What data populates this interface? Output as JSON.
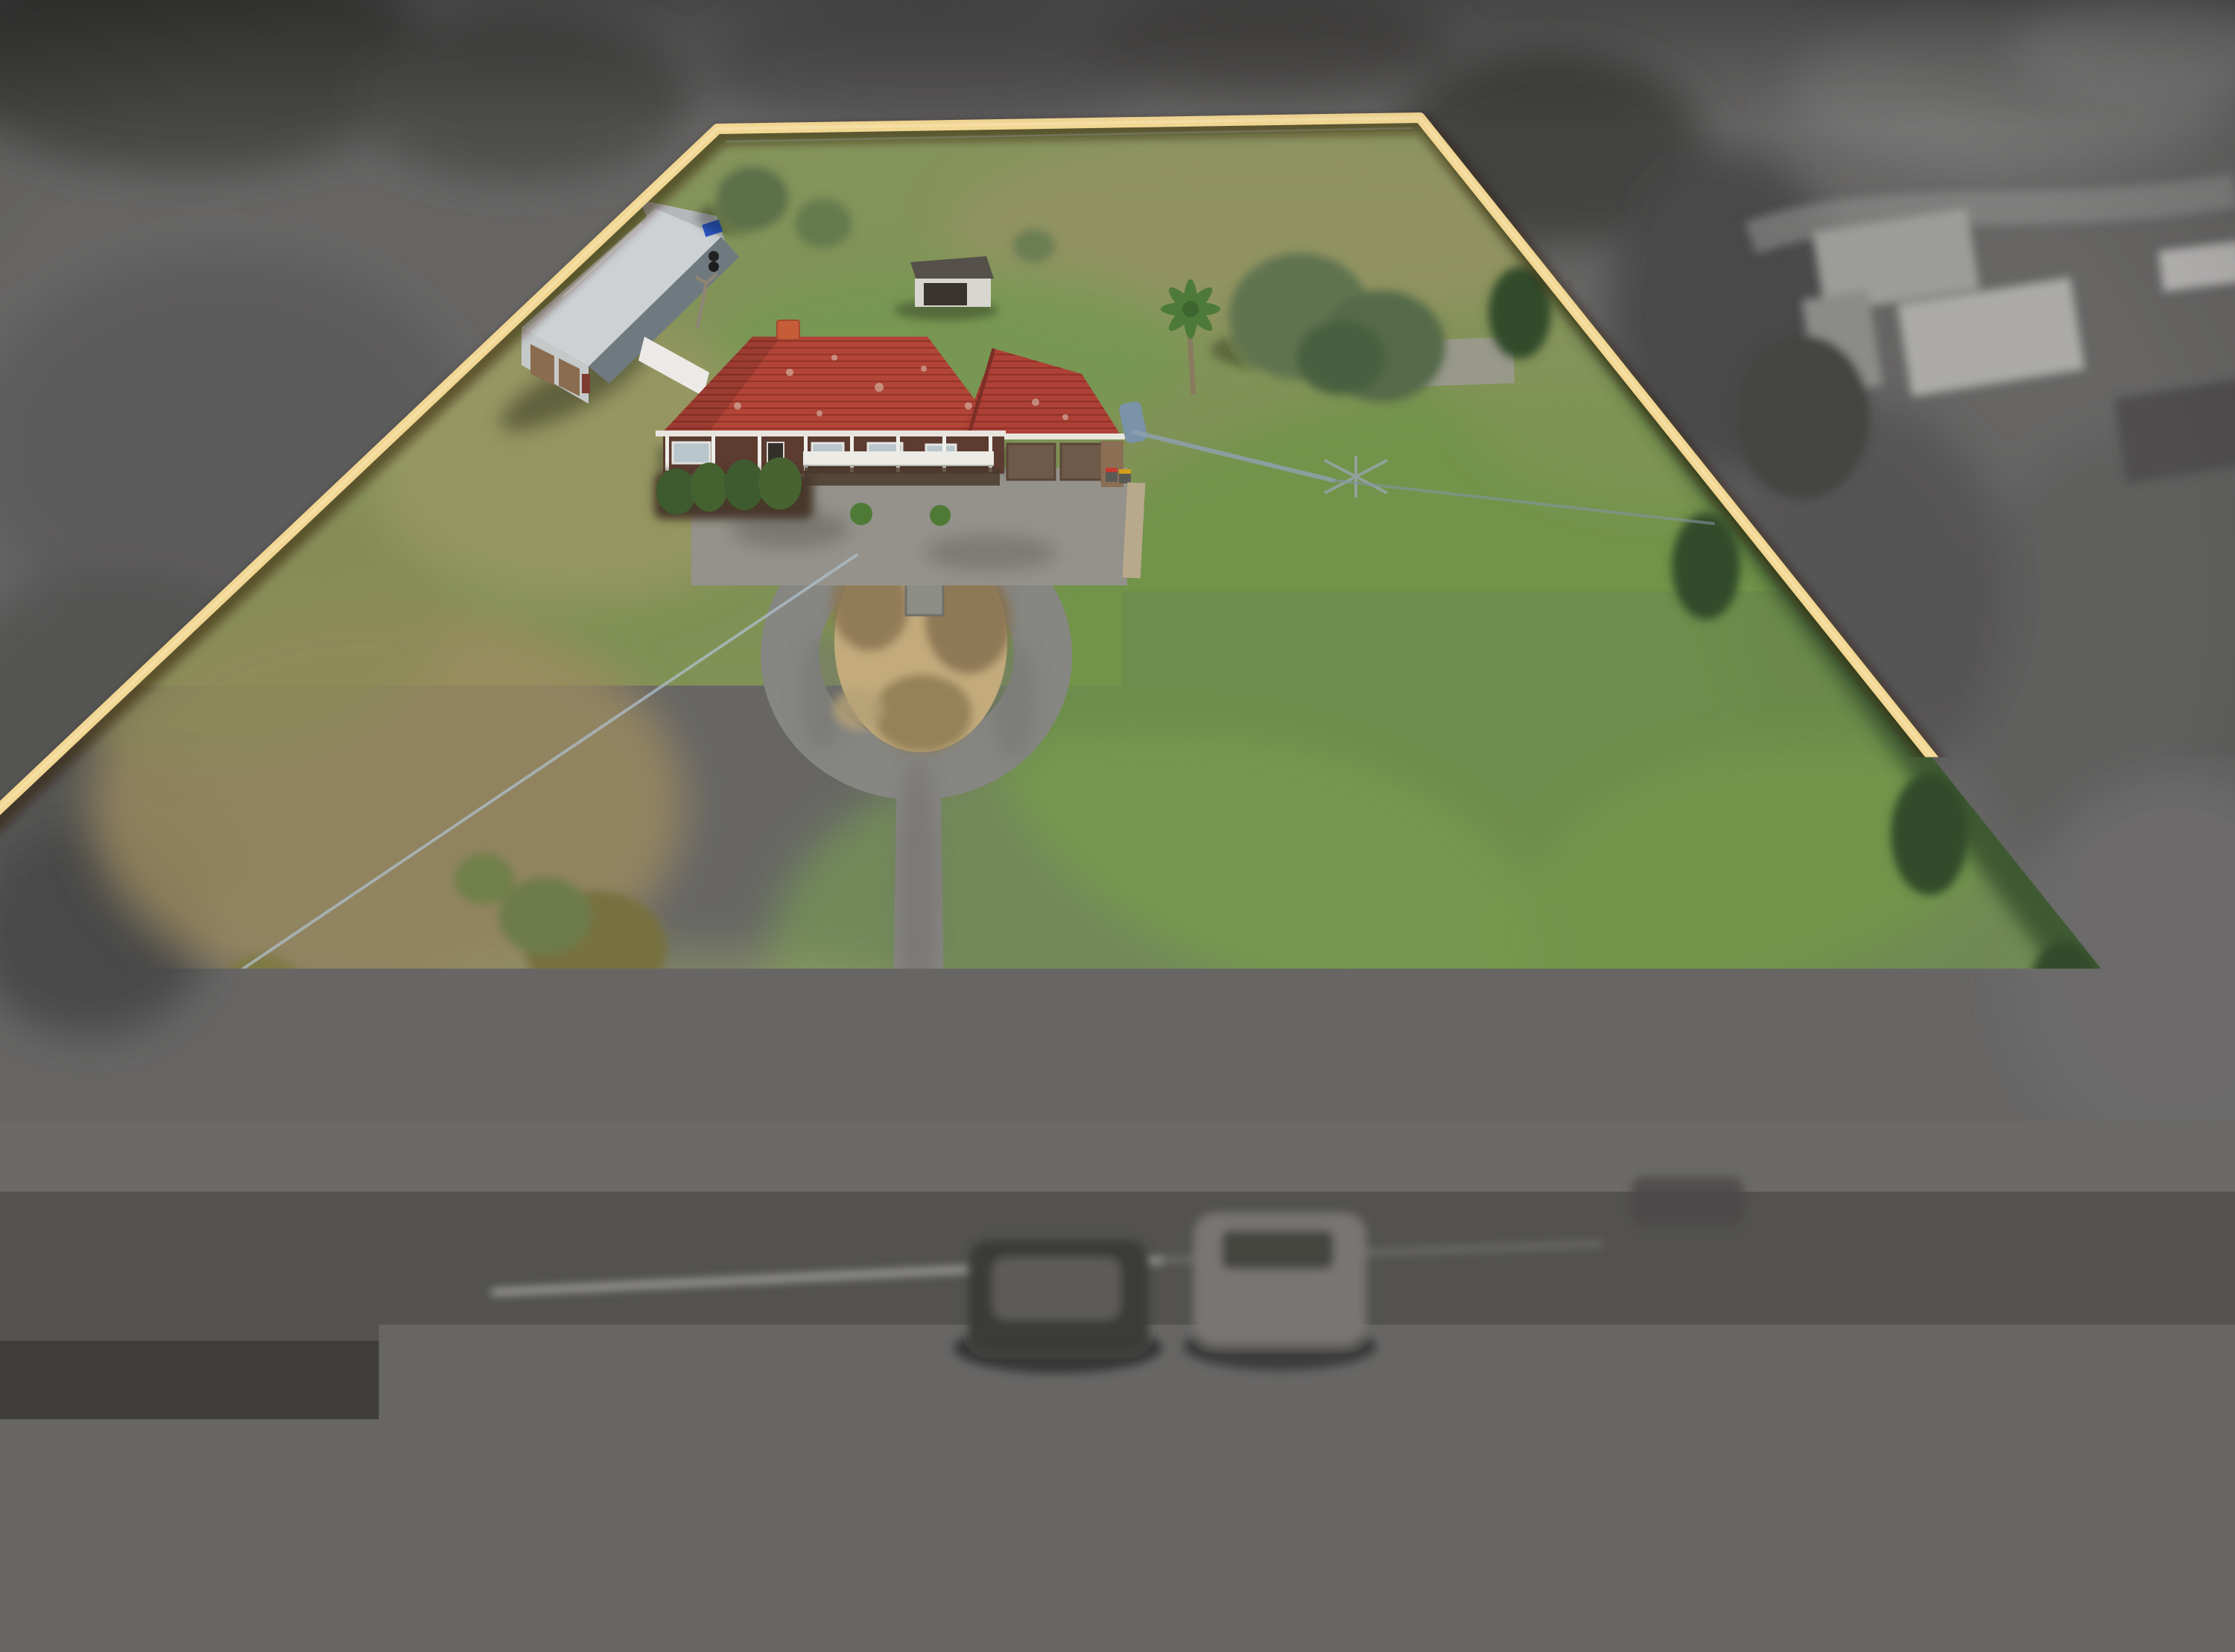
{
  "overlay": {
    "address_line1": "470 POINT COOK RD ,",
    "address_line2": "POINT COOK",
    "logo_text": "CHN",
    "watermark_rows": [
      "CHNCHNCHNCHNCHNCHNCHNCHN",
      "CHNCHNCHNCHNCHNCHNCHNCHN",
      "CHNCHNCHNCHNCHNCHNCHNCHN"
    ]
  },
  "colors": {
    "boundary_gold": "#f2d794",
    "text_cream": "#f3e0a6",
    "headline_gold": "#f5e0a2",
    "rule_gold": "#ecd28e",
    "logo_gold_light": "#ecd28b",
    "logo_gold_dark": "#b18c41",
    "watermark_gray": "#c6c6c6"
  }
}
